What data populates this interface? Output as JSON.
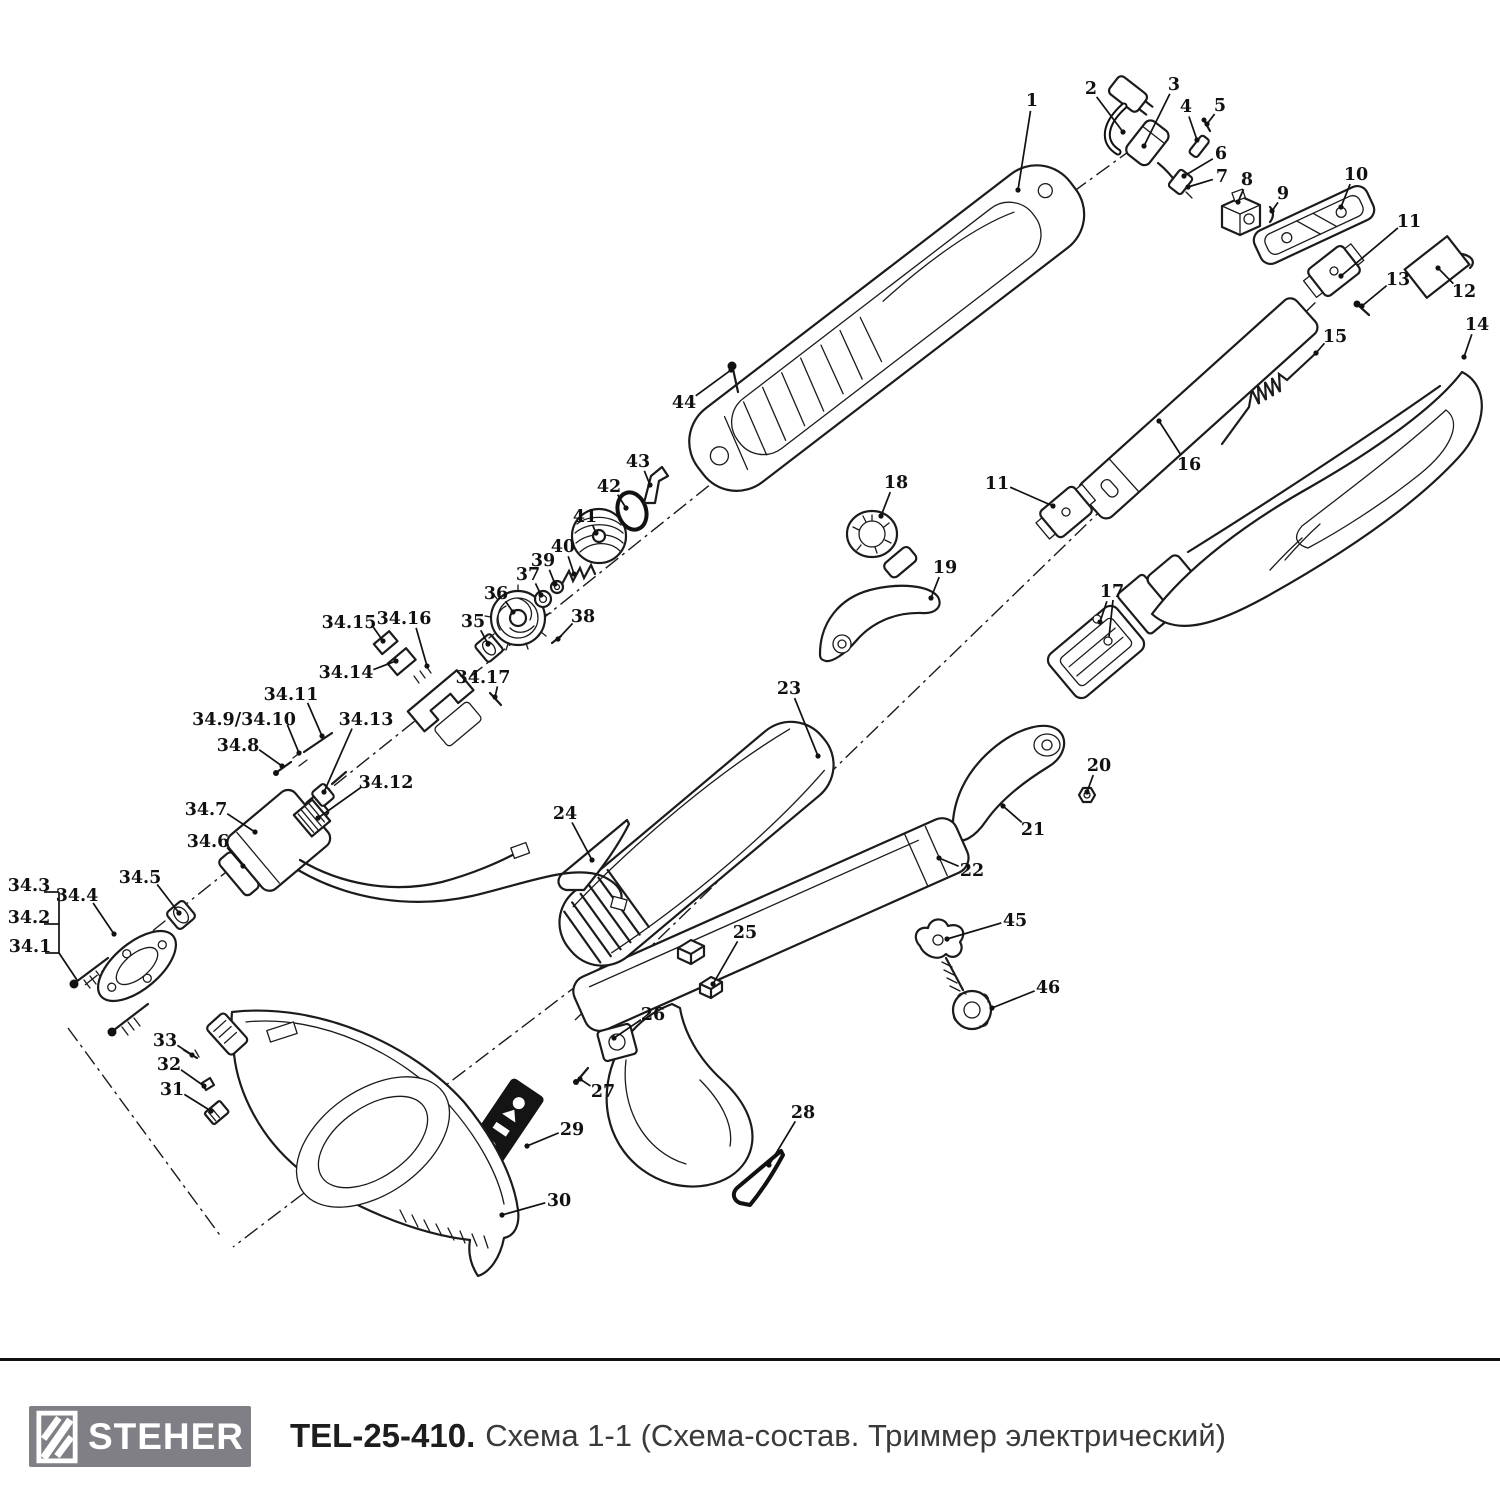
{
  "footer": {
    "brand": "STEHER",
    "model": "TEL-25-410.",
    "subtitle": "Схема 1-1 (Схема-состав. Триммер электрический)",
    "logo_bg": "#807f85",
    "ink": "#111111"
  },
  "diagram": {
    "description": "Exploded parts view of electric trimmer TEL-25-410",
    "labels": [
      {
        "t": "1",
        "x": 1032,
        "y": 100,
        "tx": 1018,
        "ty": 190
      },
      {
        "t": "2",
        "x": 1091,
        "y": 88,
        "tx": 1123,
        "ty": 132
      },
      {
        "t": "3",
        "x": 1174,
        "y": 84,
        "tx": 1144,
        "ty": 146
      },
      {
        "t": "4",
        "x": 1186,
        "y": 106,
        "tx": 1197,
        "ty": 140
      },
      {
        "t": "5",
        "x": 1220,
        "y": 105,
        "tx": 1207,
        "ty": 124
      },
      {
        "t": "6",
        "x": 1221,
        "y": 153,
        "tx": 1184,
        "ty": 176
      },
      {
        "t": "7",
        "x": 1222,
        "y": 176,
        "tx": 1188,
        "ty": 187
      },
      {
        "t": "8",
        "x": 1247,
        "y": 179,
        "tx": 1238,
        "ty": 202
      },
      {
        "t": "9",
        "x": 1283,
        "y": 193,
        "tx": 1272,
        "ty": 211
      },
      {
        "t": "10",
        "x": 1356,
        "y": 174,
        "tx": 1341,
        "ty": 207
      },
      {
        "t": "11",
        "x": 1409,
        "y": 221,
        "tx": 1341,
        "ty": 276
      },
      {
        "t": "12",
        "x": 1464,
        "y": 291,
        "tx": 1438,
        "ty": 268
      },
      {
        "t": "13",
        "x": 1398,
        "y": 279,
        "tx": 1362,
        "ty": 306
      },
      {
        "t": "14",
        "x": 1477,
        "y": 324,
        "tx": 1464,
        "ty": 357
      },
      {
        "t": "15",
        "x": 1335,
        "y": 336,
        "tx": 1316,
        "ty": 353
      },
      {
        "t": "16",
        "x": 1189,
        "y": 464,
        "tx": 1159,
        "ty": 421
      },
      {
        "t": "11",
        "x": 997,
        "y": 483,
        "tx": 1053,
        "ty": 506
      },
      {
        "t": "17",
        "x": 1112,
        "y": 591,
        "tx": 1100,
        "ty": 622
      },
      {
        "t": "18",
        "x": 896,
        "y": 482,
        "tx": 881,
        "ty": 516
      },
      {
        "t": "19",
        "x": 945,
        "y": 567,
        "tx": 931,
        "ty": 598
      },
      {
        "t": "20",
        "x": 1099,
        "y": 765,
        "tx": 1087,
        "ty": 792
      },
      {
        "t": "21",
        "x": 1033,
        "y": 829,
        "tx": 1003,
        "ty": 806
      },
      {
        "t": "22",
        "x": 972,
        "y": 870,
        "tx": 939,
        "ty": 858
      },
      {
        "t": "23",
        "x": 789,
        "y": 688,
        "tx": 818,
        "ty": 756
      },
      {
        "t": "24",
        "x": 565,
        "y": 813,
        "tx": 592,
        "ty": 860
      },
      {
        "t": "25",
        "x": 745,
        "y": 932,
        "tx": 713,
        "ty": 984
      },
      {
        "t": "26",
        "x": 653,
        "y": 1014,
        "tx": 614,
        "ty": 1038
      },
      {
        "t": "27",
        "x": 603,
        "y": 1091,
        "tx": 580,
        "ty": 1079
      },
      {
        "t": "28",
        "x": 803,
        "y": 1112,
        "tx": 769,
        "ty": 1165
      },
      {
        "t": "29",
        "x": 572,
        "y": 1129,
        "tx": 527,
        "ty": 1146
      },
      {
        "t": "30",
        "x": 559,
        "y": 1200,
        "tx": 502,
        "ty": 1215
      },
      {
        "t": "31",
        "x": 172,
        "y": 1089,
        "tx": 211,
        "ty": 1111
      },
      {
        "t": "32",
        "x": 169,
        "y": 1064,
        "tx": 204,
        "ty": 1086
      },
      {
        "t": "33",
        "x": 165,
        "y": 1040,
        "tx": 192,
        "ty": 1055
      },
      {
        "t": "44",
        "x": 684,
        "y": 402,
        "tx": 731,
        "ty": 370
      },
      {
        "t": "45",
        "x": 1015,
        "y": 920,
        "tx": 947,
        "ty": 939
      },
      {
        "t": "46",
        "x": 1048,
        "y": 987,
        "tx": 992,
        "ty": 1008
      },
      {
        "t": "34.1",
        "x": 30,
        "y": 946,
        "tx": null,
        "ty": null
      },
      {
        "t": "34.2",
        "x": 29,
        "y": 917,
        "tx": null,
        "ty": null
      },
      {
        "t": "34.3",
        "x": 29,
        "y": 885,
        "tx": null,
        "ty": null
      },
      {
        "t": "34.4",
        "x": 77,
        "y": 895,
        "tx": 114,
        "ty": 934
      },
      {
        "t": "34.5",
        "x": 140,
        "y": 877,
        "tx": 179,
        "ty": 913
      },
      {
        "t": "34.6",
        "x": 208,
        "y": 841,
        "tx": 243,
        "ty": 866
      },
      {
        "t": "34.7",
        "x": 206,
        "y": 809,
        "tx": 255,
        "ty": 832
      },
      {
        "t": "34.8",
        "x": 238,
        "y": 745,
        "tx": 282,
        "ty": 766
      },
      {
        "t": "34.9/34.10",
        "x": 244,
        "y": 719,
        "tx": 299,
        "ty": 753
      },
      {
        "t": "34.11",
        "x": 291,
        "y": 694,
        "tx": 322,
        "ty": 736
      },
      {
        "t": "34.12",
        "x": 386,
        "y": 782,
        "tx": 318,
        "ty": 818
      },
      {
        "t": "34.13",
        "x": 366,
        "y": 719,
        "tx": 324,
        "ty": 792
      },
      {
        "t": "34.14",
        "x": 346,
        "y": 672,
        "tx": 396,
        "ty": 661
      },
      {
        "t": "34.15",
        "x": 349,
        "y": 622,
        "tx": 383,
        "ty": 641
      },
      {
        "t": "34.16",
        "x": 404,
        "y": 618,
        "tx": 427,
        "ty": 666
      },
      {
        "t": "34.17",
        "x": 483,
        "y": 677,
        "tx": 495,
        "ty": 697
      },
      {
        "t": "35",
        "x": 473,
        "y": 621,
        "tx": 488,
        "ty": 644
      },
      {
        "t": "36",
        "x": 496,
        "y": 593,
        "tx": 513,
        "ty": 612
      },
      {
        "t": "37",
        "x": 528,
        "y": 574,
        "tx": 541,
        "ty": 595
      },
      {
        "t": "38",
        "x": 583,
        "y": 616,
        "tx": 558,
        "ty": 639
      },
      {
        "t": "39",
        "x": 543,
        "y": 560,
        "tx": 555,
        "ty": 584
      },
      {
        "t": "40",
        "x": 563,
        "y": 546,
        "tx": 574,
        "ty": 574
      },
      {
        "t": "41",
        "x": 585,
        "y": 516,
        "tx": 596,
        "ty": 533
      },
      {
        "t": "42",
        "x": 609,
        "y": 486,
        "tx": 626,
        "ty": 508
      },
      {
        "t": "43",
        "x": 638,
        "y": 461,
        "tx": 650,
        "ty": 485
      },
      {
        "t": "44-underline",
        "hidden": true,
        "x": 0,
        "y": 0,
        "tx": null,
        "ty": null
      }
    ],
    "extra_leader_segments": [
      [
        44,
        892,
        59,
        892
      ],
      [
        44,
        924,
        59,
        924
      ],
      [
        45,
        953,
        59,
        953
      ],
      [
        59,
        892,
        59,
        953
      ],
      [
        59,
        953,
        77,
        980
      ],
      [
        1113,
        600,
        1109,
        637
      ]
    ]
  }
}
